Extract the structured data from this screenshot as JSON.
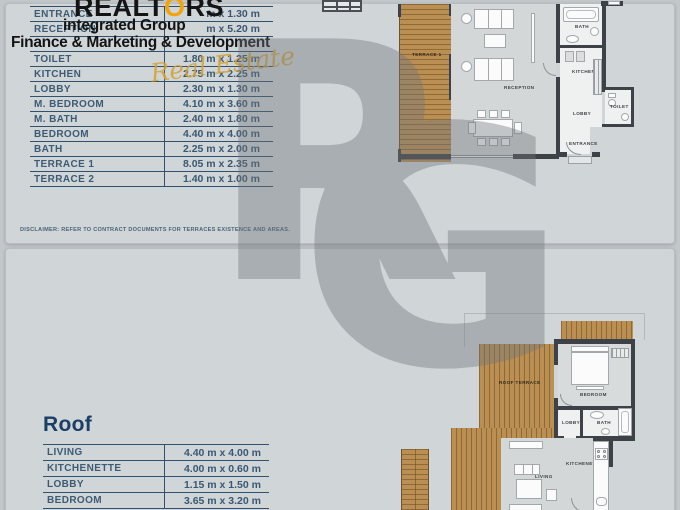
{
  "logo": {
    "title_prefix": "REALT",
    "title_o": "O",
    "title_suffix": "RS",
    "subtitle": "integrated Group",
    "tagline": "Finance & Marketing & Development",
    "script": "Real Estate",
    "accent_color": "#f2a40c"
  },
  "watermark": {
    "letter_r": "R",
    "letter_g": "G",
    "color": "#6f757b"
  },
  "dimensions_table": {
    "rows": [
      {
        "label": "ENTRANCE",
        "dim": "m x 1.30 m"
      },
      {
        "label": "RECEPTION",
        "dim": "m x 5.20 m"
      },
      {
        "label": "",
        "dim": ""
      },
      {
        "label": "TOILET",
        "dim": "1.80 m x 1.25 m"
      },
      {
        "label": "KITCHEN",
        "dim": "2.75 m x 2.25 m"
      },
      {
        "label": "LOBBY",
        "dim": "2.30 m x 1.30 m"
      },
      {
        "label": "M. BEDROOM",
        "dim": "4.10 m x 3.60 m"
      },
      {
        "label": "M. BATH",
        "dim": "2.40 m x 1.80 m"
      },
      {
        "label": "BEDROOM",
        "dim": "4.40 m x 4.00 m"
      },
      {
        "label": "BATH",
        "dim": "2.25 m x 2.00 m"
      },
      {
        "label": "TERRACE 1",
        "dim": "8.05 m x 2.35 m"
      },
      {
        "label": "TERRACE 2",
        "dim": "1.40 m x 1.00 m"
      }
    ]
  },
  "disclaimer": "DISCLAIMER: REFER TO CONTRACT DOCUMENTS FOR TERRACES EXISTENCE AND AREAS.",
  "roof_section": {
    "heading": "Roof",
    "rows": [
      {
        "label": "LIVING",
        "dim": "4.40 m x 4.00 m"
      },
      {
        "label": "KITCHENETTE",
        "dim": "4.00 m x 0.60 m"
      },
      {
        "label": "LOBBY",
        "dim": "1.15 m x 1.50 m"
      },
      {
        "label": "BEDROOM",
        "dim": "3.65 m x 3.20 m"
      }
    ]
  },
  "floorplan_top": {
    "labels": {
      "terrace": "TERRACE 1",
      "reception": "RECEPTION",
      "bath": "BATH",
      "kitchen": "KITCHEN",
      "lobby": "LOBBY",
      "toilet": "TOILET",
      "entrance": "ENTRANCE"
    }
  },
  "floorplan_roof": {
    "labels": {
      "roof_terrace": "ROOF TERRACE",
      "bedroom": "BEDROOM",
      "lobby": "LOBBY",
      "bath": "BATH",
      "kitchenette": "KITCHENETTE",
      "living": "LIVING"
    }
  }
}
